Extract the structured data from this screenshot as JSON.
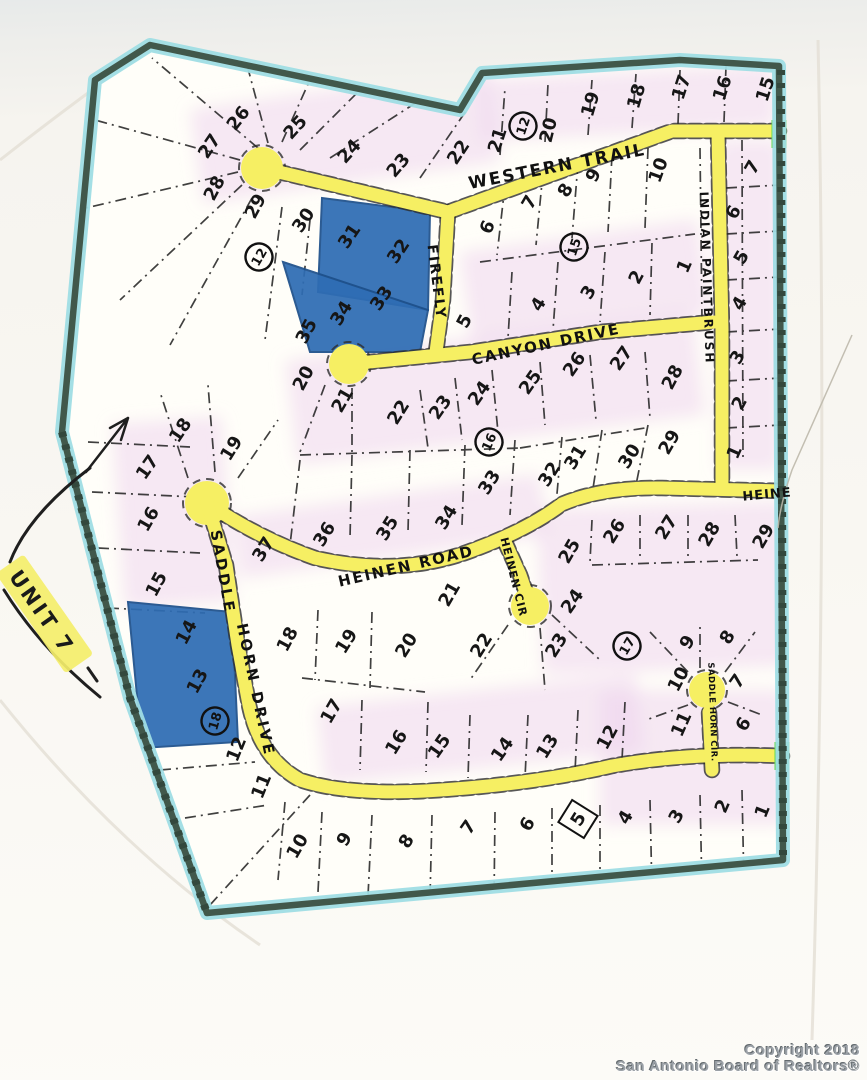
{
  "unit": {
    "text": "UNIT 7",
    "x": 42,
    "y": 612,
    "r": 55
  },
  "copyright": {
    "line1": "Copyright 2018",
    "line2": "San Antonio Board of Realtors®"
  },
  "colors": {
    "road_highlight": "#f6ef63",
    "boundary": "#41584b",
    "boundary_glow": "#9fdde4",
    "lot_highlight_blue": "#2e6cb3",
    "road_end_green": "#66d94d",
    "lot_shading_pink": "#eed2ee",
    "ink": "#1c1c1c"
  },
  "streets": [
    {
      "name": "WESTERN TRAIL",
      "x": 557,
      "y": 166,
      "r": -11,
      "size": 17,
      "ls": 2
    },
    {
      "name": "FIREFLY",
      "x": 437,
      "y": 282,
      "r": 83,
      "size": 14,
      "ls": 2
    },
    {
      "name": "CANYON  DRIVE",
      "x": 546,
      "y": 344,
      "r": -12,
      "size": 15,
      "ls": 2
    },
    {
      "name": "INDIAN  PAINTBRUSH",
      "x": 707,
      "y": 278,
      "r": 88,
      "size": 12,
      "ls": 2
    },
    {
      "name": "HEINEN ROAD",
      "x": 406,
      "y": 566,
      "r": -13,
      "size": 15,
      "ls": 2
    },
    {
      "name": "HEINEN CIR",
      "x": 514,
      "y": 577,
      "r": 76,
      "size": 11,
      "ls": 1
    },
    {
      "name": "HEINE",
      "x": 767,
      "y": 494,
      "r": -5,
      "size": 13,
      "ls": 1
    },
    {
      "name": "SADDLE",
      "x": 223,
      "y": 572,
      "r": 80,
      "size": 15,
      "ls": 3
    },
    {
      "name": "HORN DRIVE",
      "x": 256,
      "y": 690,
      "r": 78,
      "size": 15,
      "ls": 3
    },
    {
      "name": "SADDLE HORN CIR.",
      "x": 713,
      "y": 712,
      "r": 88,
      "size": 8.5,
      "ls": 0.5
    }
  ],
  "blocks": [
    {
      "n": "12",
      "x": 259,
      "y": 257,
      "r": -60
    },
    {
      "n": "12",
      "x": 523,
      "y": 126,
      "r": -72
    },
    {
      "n": "15",
      "x": 574,
      "y": 247,
      "r": -72
    },
    {
      "n": "16",
      "x": 489,
      "y": 442,
      "r": -66
    },
    {
      "n": "17",
      "x": 627,
      "y": 646,
      "r": -60
    },
    {
      "n": "18",
      "x": 215,
      "y": 721,
      "r": -74
    }
  ],
  "lots": [
    {
      "n": "26",
      "x": 238,
      "y": 118,
      "r": -52
    },
    {
      "n": "27",
      "x": 209,
      "y": 146,
      "r": -56
    },
    {
      "n": "28",
      "x": 214,
      "y": 188,
      "r": -62
    },
    {
      "n": "25",
      "x": 295,
      "y": 127,
      "r": -48
    },
    {
      "n": "24",
      "x": 349,
      "y": 151,
      "r": -48
    },
    {
      "n": "23",
      "x": 398,
      "y": 165,
      "r": -50
    },
    {
      "n": "22",
      "x": 458,
      "y": 152,
      "r": -56
    },
    {
      "n": "21",
      "x": 497,
      "y": 140,
      "r": -72
    },
    {
      "n": "20",
      "x": 548,
      "y": 130,
      "r": -76
    },
    {
      "n": "19",
      "x": 590,
      "y": 104,
      "r": -74
    },
    {
      "n": "18",
      "x": 636,
      "y": 96,
      "r": -74
    },
    {
      "n": "17",
      "x": 681,
      "y": 87,
      "r": -72
    },
    {
      "n": "16",
      "x": 722,
      "y": 88,
      "r": -72
    },
    {
      "n": "15",
      "x": 765,
      "y": 89,
      "r": -72
    },
    {
      "n": "29",
      "x": 255,
      "y": 206,
      "r": -62
    },
    {
      "n": "30",
      "x": 303,
      "y": 220,
      "r": -56
    },
    {
      "n": "31",
      "x": 349,
      "y": 236,
      "r": -56
    },
    {
      "n": "32",
      "x": 398,
      "y": 251,
      "r": -56
    },
    {
      "n": "33",
      "x": 381,
      "y": 298,
      "r": -56
    },
    {
      "n": "34",
      "x": 341,
      "y": 313,
      "r": -58
    },
    {
      "n": "35",
      "x": 306,
      "y": 331,
      "r": -62
    },
    {
      "n": "6",
      "x": 487,
      "y": 227,
      "r": -66
    },
    {
      "n": "7",
      "x": 529,
      "y": 202,
      "r": -60
    },
    {
      "n": "8",
      "x": 565,
      "y": 190,
      "r": -60
    },
    {
      "n": "9",
      "x": 593,
      "y": 175,
      "r": -62
    },
    {
      "n": "10",
      "x": 658,
      "y": 170,
      "r": -70
    },
    {
      "n": "5",
      "x": 464,
      "y": 321,
      "r": -62
    },
    {
      "n": "4",
      "x": 538,
      "y": 304,
      "r": -58
    },
    {
      "n": "3",
      "x": 588,
      "y": 292,
      "r": -60
    },
    {
      "n": "2",
      "x": 636,
      "y": 277,
      "r": -62
    },
    {
      "n": "1",
      "x": 684,
      "y": 266,
      "r": -66
    },
    {
      "n": "7",
      "x": 752,
      "y": 167,
      "r": -60
    },
    {
      "n": "6",
      "x": 733,
      "y": 212,
      "r": -62
    },
    {
      "n": "5",
      "x": 741,
      "y": 257,
      "r": -60
    },
    {
      "n": "4",
      "x": 739,
      "y": 303,
      "r": -60
    },
    {
      "n": "3",
      "x": 737,
      "y": 357,
      "r": -60
    },
    {
      "n": "2",
      "x": 739,
      "y": 403,
      "r": -62
    },
    {
      "n": "1",
      "x": 734,
      "y": 452,
      "r": -66
    },
    {
      "n": "20",
      "x": 303,
      "y": 378,
      "r": -62
    },
    {
      "n": "21",
      "x": 342,
      "y": 400,
      "r": -60
    },
    {
      "n": "22",
      "x": 398,
      "y": 412,
      "r": -58
    },
    {
      "n": "23",
      "x": 440,
      "y": 407,
      "r": -55
    },
    {
      "n": "24",
      "x": 479,
      "y": 393,
      "r": -55
    },
    {
      "n": "25",
      "x": 530,
      "y": 382,
      "r": -55
    },
    {
      "n": "26",
      "x": 574,
      "y": 364,
      "r": -55
    },
    {
      "n": "27",
      "x": 621,
      "y": 358,
      "r": -55
    },
    {
      "n": "28",
      "x": 672,
      "y": 377,
      "r": -62
    },
    {
      "n": "29",
      "x": 669,
      "y": 442,
      "r": -60
    },
    {
      "n": "30",
      "x": 629,
      "y": 456,
      "r": -58
    },
    {
      "n": "31",
      "x": 575,
      "y": 457,
      "r": -58
    },
    {
      "n": "32",
      "x": 549,
      "y": 474,
      "r": -58
    },
    {
      "n": "33",
      "x": 489,
      "y": 482,
      "r": -58
    },
    {
      "n": "34",
      "x": 446,
      "y": 517,
      "r": -58
    },
    {
      "n": "35",
      "x": 387,
      "y": 528,
      "r": -58
    },
    {
      "n": "36",
      "x": 324,
      "y": 534,
      "r": -58
    },
    {
      "n": "37",
      "x": 263,
      "y": 549,
      "r": -58
    },
    {
      "n": "18",
      "x": 180,
      "y": 430,
      "r": -56
    },
    {
      "n": "19",
      "x": 231,
      "y": 448,
      "r": -58
    },
    {
      "n": "17",
      "x": 147,
      "y": 467,
      "r": -55
    },
    {
      "n": "16",
      "x": 148,
      "y": 519,
      "r": -60
    },
    {
      "n": "15",
      "x": 156,
      "y": 584,
      "r": -62
    },
    {
      "n": "25",
      "x": 569,
      "y": 551,
      "r": -60
    },
    {
      "n": "26",
      "x": 614,
      "y": 531,
      "r": -58
    },
    {
      "n": "27",
      "x": 666,
      "y": 527,
      "r": -58
    },
    {
      "n": "28",
      "x": 709,
      "y": 534,
      "r": -60
    },
    {
      "n": "29",
      "x": 763,
      "y": 536,
      "r": -60
    },
    {
      "n": "24",
      "x": 572,
      "y": 601,
      "r": -55
    },
    {
      "n": "21",
      "x": 449,
      "y": 594,
      "r": -60
    },
    {
      "n": "18",
      "x": 287,
      "y": 639,
      "r": -62
    },
    {
      "n": "19",
      "x": 346,
      "y": 641,
      "r": -58
    },
    {
      "n": "20",
      "x": 406,
      "y": 645,
      "r": -58
    },
    {
      "n": "22",
      "x": 481,
      "y": 645,
      "r": -58
    },
    {
      "n": "23",
      "x": 556,
      "y": 645,
      "r": -58
    },
    {
      "n": "9",
      "x": 687,
      "y": 642,
      "r": -58
    },
    {
      "n": "8",
      "x": 727,
      "y": 637,
      "r": -58
    },
    {
      "n": "10",
      "x": 678,
      "y": 679,
      "r": -62
    },
    {
      "n": "7",
      "x": 737,
      "y": 681,
      "r": -55
    },
    {
      "n": "11",
      "x": 681,
      "y": 724,
      "r": -66
    },
    {
      "n": "6",
      "x": 743,
      "y": 724,
      "r": -58
    },
    {
      "n": "14",
      "x": 186,
      "y": 632,
      "r": -62
    },
    {
      "n": "13",
      "x": 197,
      "y": 681,
      "r": -62
    },
    {
      "n": "12",
      "x": 236,
      "y": 749,
      "r": -68
    },
    {
      "n": "11",
      "x": 261,
      "y": 786,
      "r": -68
    },
    {
      "n": "17",
      "x": 331,
      "y": 711,
      "r": -60
    },
    {
      "n": "16",
      "x": 396,
      "y": 742,
      "r": -58
    },
    {
      "n": "15",
      "x": 439,
      "y": 746,
      "r": -55
    },
    {
      "n": "14",
      "x": 502,
      "y": 749,
      "r": -55
    },
    {
      "n": "13",
      "x": 547,
      "y": 746,
      "r": -58
    },
    {
      "n": "12",
      "x": 607,
      "y": 737,
      "r": -62
    },
    {
      "n": "10",
      "x": 297,
      "y": 846,
      "r": -60
    },
    {
      "n": "9",
      "x": 344,
      "y": 839,
      "r": -58
    },
    {
      "n": "8",
      "x": 406,
      "y": 841,
      "r": -58
    },
    {
      "n": "7",
      "x": 468,
      "y": 827,
      "r": -55
    },
    {
      "n": "6",
      "x": 527,
      "y": 824,
      "r": -58
    },
    {
      "n": "5",
      "x": 578,
      "y": 819,
      "r": -58,
      "boxed": true
    },
    {
      "n": "4",
      "x": 625,
      "y": 817,
      "r": -60
    },
    {
      "n": "3",
      "x": 676,
      "y": 816,
      "r": -60
    },
    {
      "n": "2",
      "x": 722,
      "y": 806,
      "r": -66
    },
    {
      "n": "1",
      "x": 762,
      "y": 811,
      "r": -68
    }
  ]
}
